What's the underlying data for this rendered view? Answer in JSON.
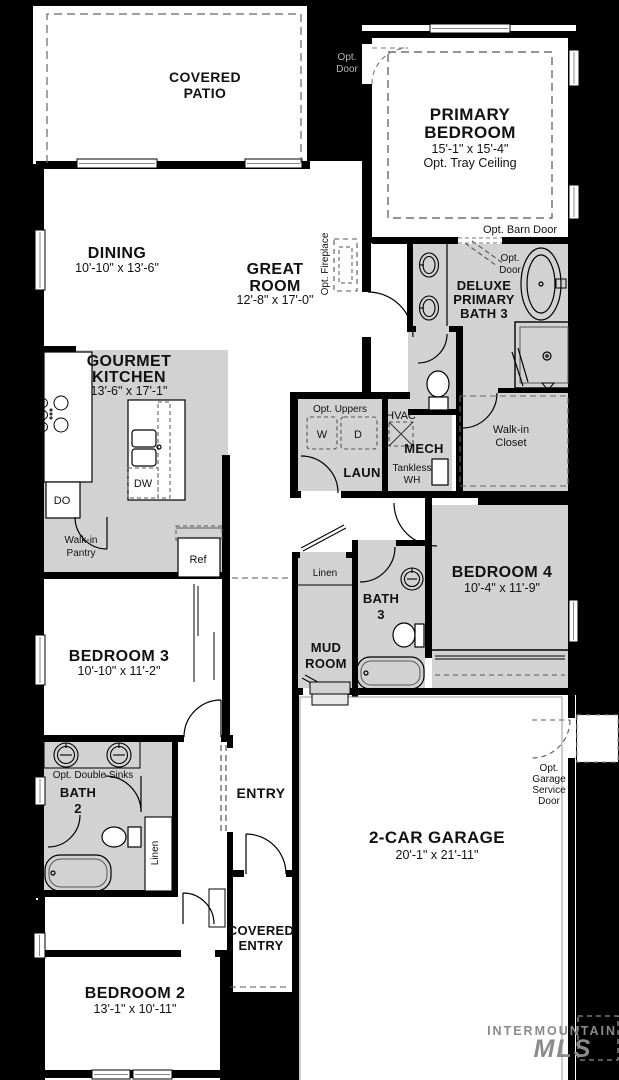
{
  "colors": {
    "background": "#000000",
    "floor": "#ffffff",
    "shaded": "#d2d2d2",
    "wall": "#000000",
    "dash": "#666666",
    "watermark": "#8a8a8a"
  },
  "rooms": {
    "covered_patio": {
      "l1": "COVERED",
      "l2": "PATIO"
    },
    "primary_bedroom": {
      "l1": "PRIMARY",
      "l2": "BEDROOM",
      "dims": "15'-1\" x 15'-4\"",
      "note": "Opt. Tray Ceiling"
    },
    "dining": {
      "name": "DINING",
      "dims": "10'-10\" x 13'-6\""
    },
    "great_room": {
      "l1": "GREAT",
      "l2": "ROOM",
      "dims": "12'-8\" x 17'-0\""
    },
    "kitchen": {
      "l1": "GOURMET",
      "l2": "KITCHEN",
      "dims": "13'-6\" x 17'-1\""
    },
    "primary_bath": {
      "l1": "DELUXE",
      "l2": "PRIMARY",
      "l3": "BATH 3"
    },
    "walk_in_closet": {
      "l1": "Walk-in",
      "l2": "Closet"
    },
    "laundry": {
      "name": "LAUN"
    },
    "mech": {
      "name": "MECH"
    },
    "bedroom4": {
      "name": "BEDROOM 4",
      "dims": "10'-4\" x 11'-9\""
    },
    "bath3": {
      "l1": "BATH",
      "l2": "3"
    },
    "mud_room": {
      "l1": "MUD",
      "l2": "ROOM"
    },
    "bedroom3": {
      "name": "BEDROOM 3",
      "dims": "10'-10\" x 11'-2\""
    },
    "bath2": {
      "l1": "BATH",
      "l2": "2"
    },
    "entry": {
      "name": "ENTRY"
    },
    "covered_entry": {
      "l1": "COVERED",
      "l2": "ENTRY"
    },
    "bedroom2": {
      "name": "BEDROOM 2",
      "dims": "13'-1\" x 10'-11\""
    },
    "garage": {
      "name": "2-CAR GARAGE",
      "dims": "20'-1\" x 21'-11\""
    }
  },
  "labels": {
    "opt_door_patio": {
      "l1": "Opt.",
      "l2": "Door"
    },
    "opt_door_bath": {
      "l1": "Opt.",
      "l2": "Door"
    },
    "opt_barn_door": "Opt. Barn Door",
    "opt_fireplace": "Opt. Fireplace",
    "opt_uppers": "Opt. Uppers",
    "washer": "W",
    "dryer": "D",
    "hvac": "HVAC",
    "tankless": {
      "l1": "Tankless",
      "l2": "WH"
    },
    "appliances": {
      "double_oven": "DO",
      "dishwasher": "DW",
      "fridge": "Ref"
    },
    "pantry": {
      "l1": "Walk-in",
      "l2": "Pantry"
    },
    "linen_hall": "Linen",
    "linen_entry": "Linen",
    "opt_double_sinks": "Opt. Double Sinks",
    "opt_garage_service": {
      "l1": "Opt.",
      "l2": "Garage",
      "l3": "Service",
      "l4": "Door"
    }
  },
  "watermark": {
    "l1": "INTERMOUNTAIN",
    "l2": "MLS"
  }
}
